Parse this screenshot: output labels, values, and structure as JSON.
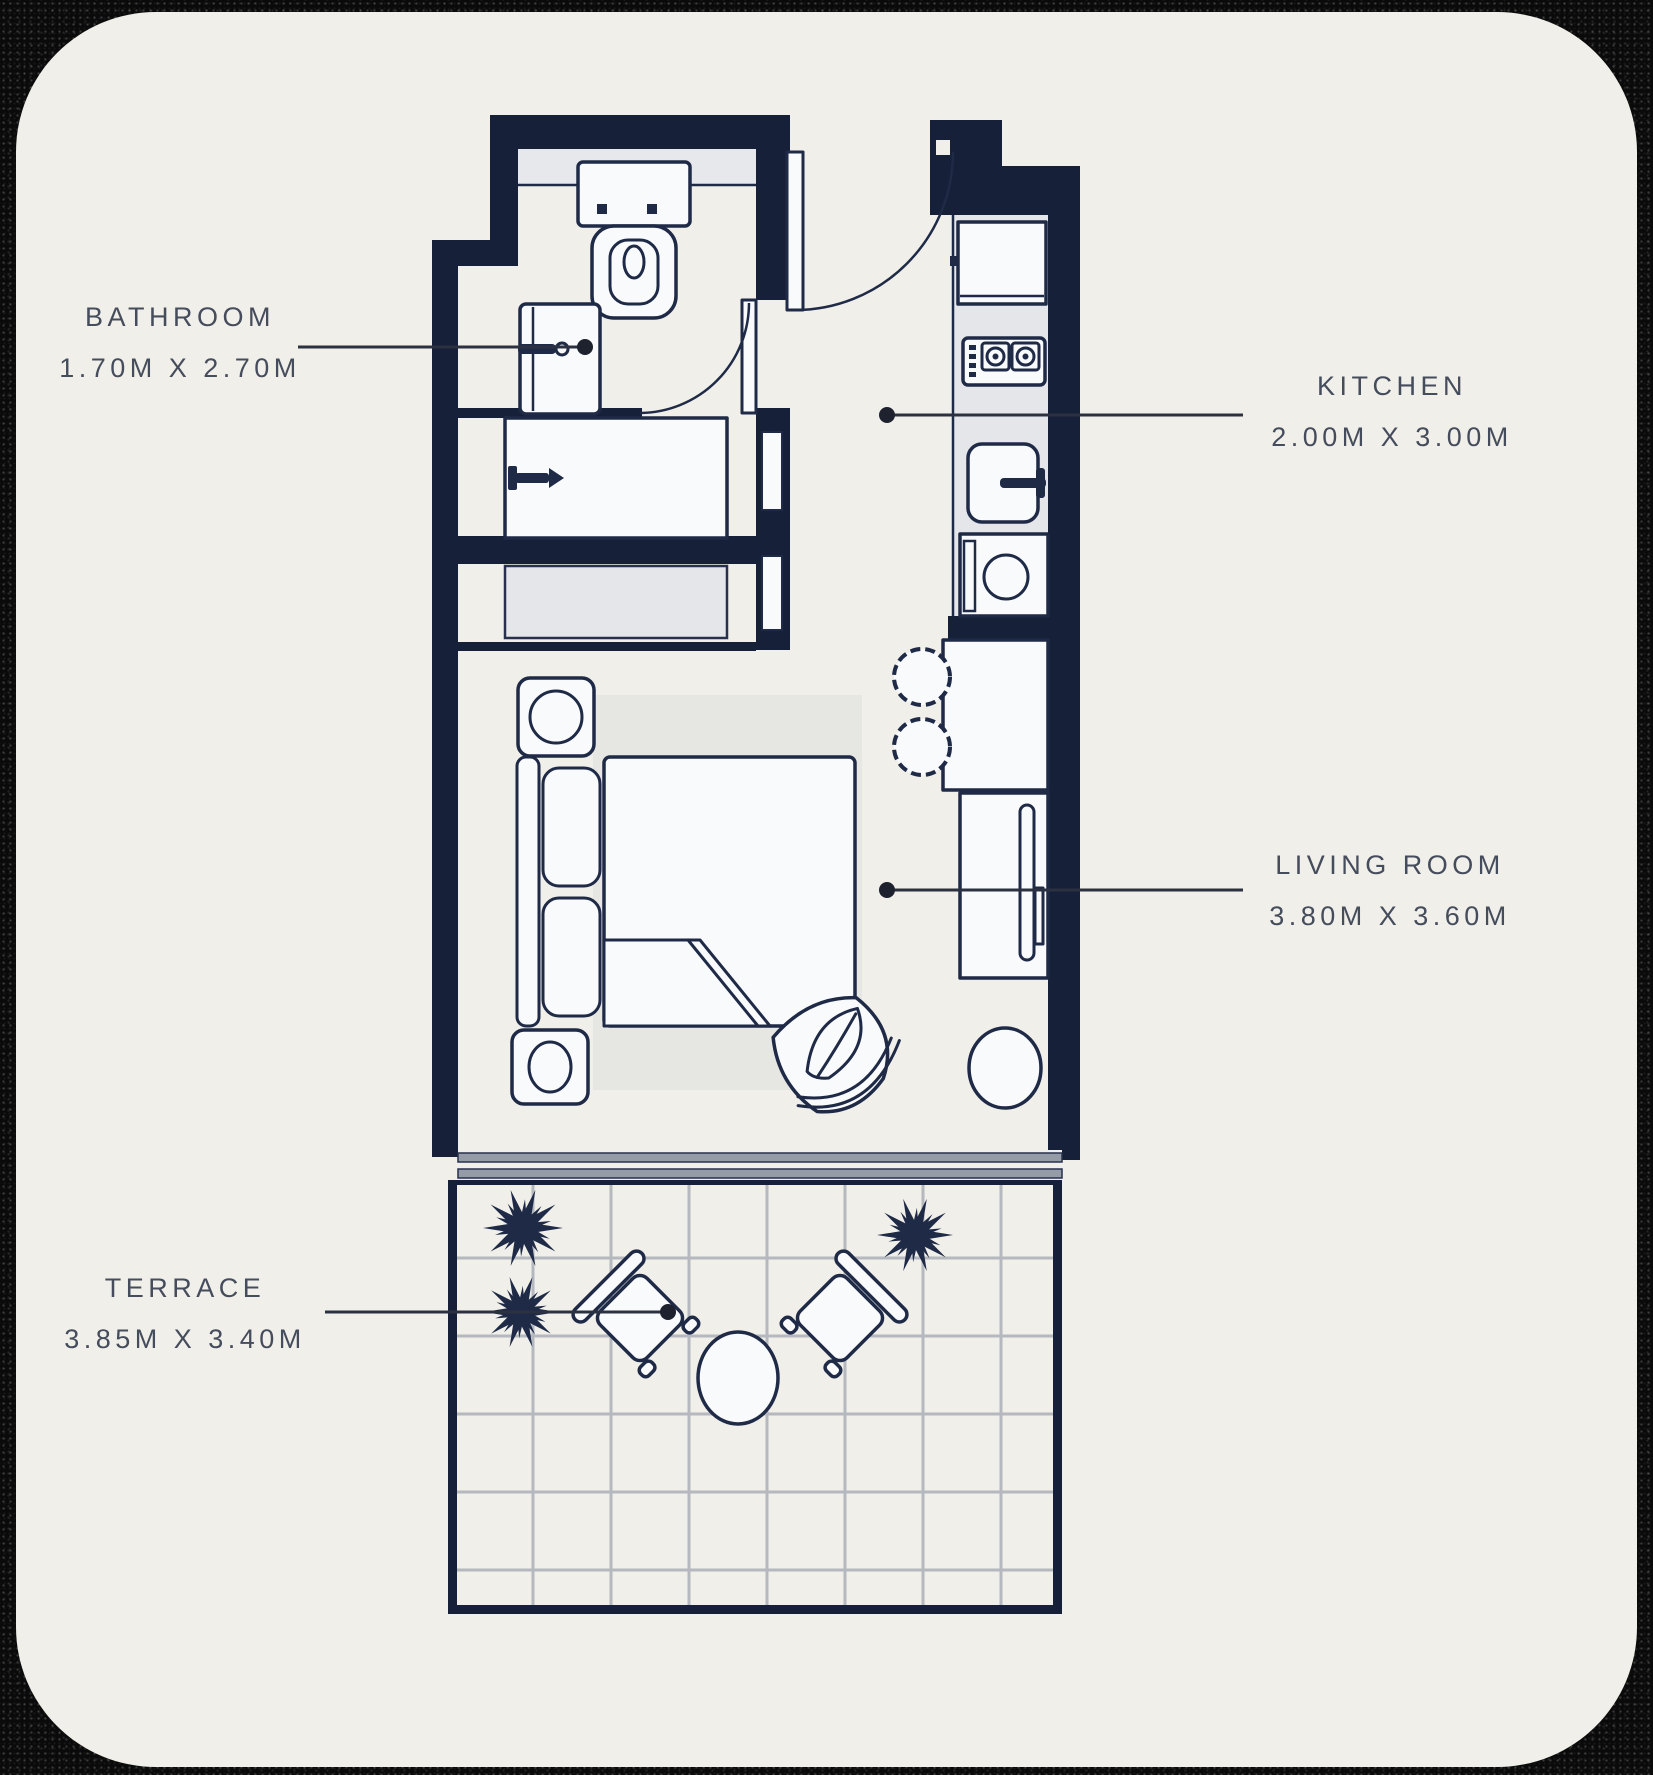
{
  "palette": {
    "outer_background": "#0a0a0a",
    "card_background": "#f0efe9",
    "wall": "#172039",
    "furniture_outline": "#1f2a47",
    "furniture_fill": "#f8fafc",
    "counter_gray": "#e4e6ea",
    "rug_gray": "#e6e6e2",
    "tile_line": "#b5b8be",
    "slider_rail": "#959ca8",
    "leader_line": "#2b3140",
    "label_text": "#454c5c"
  },
  "rooms": [
    {
      "key": "bathroom",
      "name": "BATHROOM",
      "dims": "1.70M X 2.70M"
    },
    {
      "key": "kitchen",
      "name": "KITCHEN",
      "dims": "2.00M X 3.00M"
    },
    {
      "key": "living_room",
      "name": "LIVING ROOM",
      "dims": "3.80M X 3.60M"
    },
    {
      "key": "terrace",
      "name": "TERRACE",
      "dims": "3.85M X 3.40M"
    }
  ],
  "fixtures": [
    "toilet-icon",
    "bathroom-vanity-icon",
    "faucet-icon",
    "shower-icon",
    "wardrobe-icon",
    "fridge-icon",
    "stove-icon",
    "kitchen-sink-icon",
    "washing-machine-icon",
    "bar-stool-icon",
    "breakfast-counter",
    "tv-console",
    "tv-icon",
    "bed-icon",
    "pillow-icon",
    "nightstand-icon",
    "lamp-icon",
    "rug",
    "accent-chair-icon",
    "side-table-icon",
    "outdoor-chair-icon",
    "outdoor-table-icon",
    "plant-icon",
    "door-swing-icon",
    "sliding-door-icon"
  ]
}
